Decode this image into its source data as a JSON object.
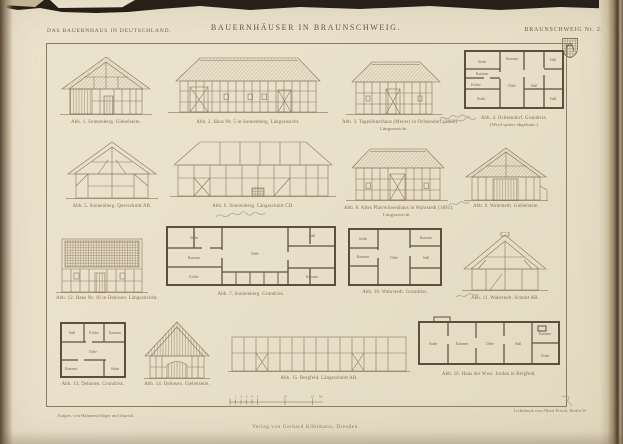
{
  "header": {
    "series_title": "DAS BAUERNHAUS IN DEUTSCHLAND.",
    "plate_title": "BAUERNHÄUSER IN BRAUNSCHWEIG.",
    "plate_number": "BRAUNSCHWEIG Nr. 2."
  },
  "figures": {
    "abb1": {
      "caption": "Abb. 1. Sonnenberg. Giebelseite."
    },
    "abb2": {
      "caption": "Abb. 2. Haus Nr. 5 in Sonnenberg. Längsansicht."
    },
    "abb3": {
      "caption": "Abb. 3. Tagelöhnerhaus (Meyer) in Ochsendorf (1666).",
      "caption2": "Längsansicht."
    },
    "abb4": {
      "caption": "Abb. 4. Ochsendorf. Grundriss.",
      "caption2": "(Wird später abgebaut.)",
      "rooms": [
        "Stube",
        "Kammer",
        "Küche",
        "Stube",
        "Kammer",
        "Diele",
        "Stall",
        "Stall",
        "Stall"
      ]
    },
    "abb5": {
      "caption": "Abb. 5. Sonnenberg. Querschnitt AB."
    },
    "abb6": {
      "caption": "Abb. 6. Sonnenberg. Längsschnitt CD."
    },
    "abb7": {
      "caption": "Abb. 7. Sonnenberg. Grundriss.",
      "rooms": [
        "Stube",
        "Kammer",
        "Küche",
        "Diele",
        "Stall",
        "Kammer"
      ]
    },
    "abb8": {
      "caption": "Abb. 8. Altes Pfarrwitwenhaus in Wahrstedt (1691).",
      "caption2": "Längsansicht."
    },
    "abb9": {
      "caption": "Abb. 9. Wahrstedt. Giebelseite."
    },
    "abb10": {
      "caption": "Abb. 10. Wahrstedt. Grundriss.",
      "rooms": [
        "Stube",
        "Kammer",
        "Diele",
        "Stall",
        "Kammer"
      ]
    },
    "abb11": {
      "caption": "Abb. 11. Wahrstedt. Schnitt AB."
    },
    "abb12": {
      "caption": "Abb. 12. Haus Nr. 18 in Dehnsen. Längsansicht."
    },
    "abb13": {
      "caption": "Abb. 13. Dehnsen. Grundriss.",
      "rooms": [
        "Stall",
        "Küche",
        "Kammer",
        "Diele",
        "Stube",
        "Kammer"
      ]
    },
    "abb14": {
      "caption": "Abb. 14. Dehnsen. Giebelseite."
    },
    "abb15": {
      "caption": "Abb. 15. Bergfeld. Längsschnitt AB."
    },
    "abb16": {
      "caption": "Abb. 16. Haus der Wwe. Jordan in Bergfeld.",
      "rooms": [
        "Stube",
        "Kammer",
        "Diele",
        "Stall",
        "Kammer",
        "Stube"
      ]
    }
  },
  "footer": {
    "surveyor_credit": "Aufgen. von Hahnenschläger und Jaurich.",
    "printer_credit": "Lichtdruck von Albert Frisch, Berlin W.",
    "publisher": "Verlag von Gerhard Kühtmann, Dresden.",
    "scale_ticks": [
      "1",
      "2",
      "3",
      "4",
      "5",
      "10",
      "15",
      "M."
    ]
  },
  "colors": {
    "paper": "#e9e0ca",
    "ink": "#8a7660",
    "caption_ink": "#7d6b54",
    "plan_wall": "#5d4f40",
    "page_edge_dark": "#241d15"
  }
}
